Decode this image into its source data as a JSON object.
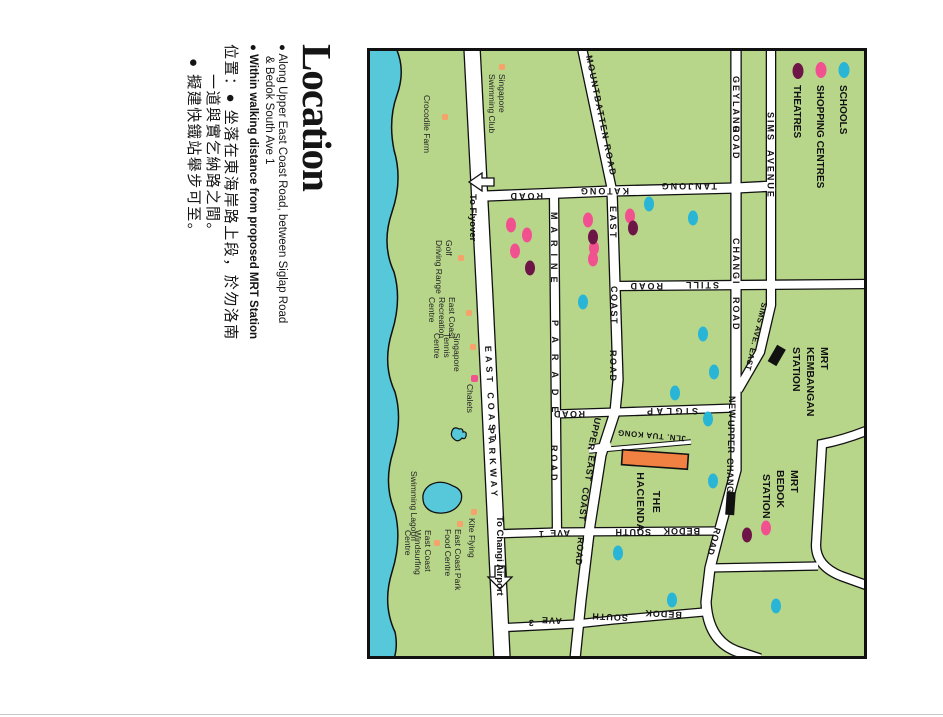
{
  "content": {
    "title": "Location",
    "bullet1_line1": "● Along Upper East Coast Road, between Siglap Road",
    "bullet1_line2": "& Bedok South Ave 1",
    "bullet2": "● Within walking distance from proposed MRT Station",
    "zh_line1": "位置：● 坐落在東海岸路上段，於勿洛南",
    "zh_line2": "一道與實乞納路之間。",
    "zh_line3": "● 擬建快鐵站舉步可至。"
  },
  "legend": {
    "schools": "SCHOOLS",
    "shopping": "SHOPPING CENTRES",
    "theatres": "THEATRES"
  },
  "roads": {
    "mountbatten": "MOUNTBATTEN ROAD",
    "geylang": "GEYLANG",
    "geylang_road": "ROAD",
    "sims": "SIMS",
    "sims_avenue": "AVENUE",
    "sims_ave_east": "SIMS AVE. EAST",
    "changi": "CHANGI",
    "changi_road": "ROAD",
    "tanjong": "TANJONG",
    "katong": "KATONG",
    "tanjong_road": "ROAD",
    "still": "STILL",
    "still_road": "ROAD",
    "east": "EAST",
    "coast": "COAST",
    "east_coast_road": "ROAD",
    "marine": "MARINE",
    "parade": "PARADE",
    "marine_road": "ROAD",
    "upper": "UPPER",
    "upper_east": "EAST",
    "upper_coast": "COAST",
    "upper_road": "ROAD",
    "new_word": "NEW",
    "new_upper": "UPPER",
    "new_changi": "CHANGI",
    "new_road": "ROAD",
    "siglap": "SIGLAP",
    "siglap_road": "ROAD",
    "bsa1_bedok": "BEDOK",
    "bsa1_south": "SOUTH",
    "bsa1_ave": "AVE",
    "bsa1_num": "1",
    "bsa3_bedok": "BEDOK",
    "bsa3_south": "SOUTH",
    "bsa3_ave": "AVE",
    "bsa3_num": "3",
    "ecp_east_coast": "EAST COAST",
    "ecp_parkway": "PARKWAY",
    "jln_tua_kong": "JLN. TUA KONG"
  },
  "stations": {
    "kembangan": [
      "MRT",
      "KEMBANGAN",
      "STATION"
    ],
    "bedok": [
      "MRT",
      "BEDOK",
      "STATION"
    ]
  },
  "places": {
    "swim1": "Singapore",
    "swim2": "Swimming Club",
    "crocodile": "Crocodile Farm",
    "golf1": "Golf",
    "golf2": "Driving Range",
    "rec1": "East Coast",
    "rec2": "Recreation",
    "rec3": "Centre",
    "tennis1": "Singapore",
    "tennis2": "Tennis",
    "tennis3": "Centre",
    "chalets": "Chalets",
    "lagoon": "Swimming Lagoon",
    "kite": "Kite Flying",
    "food1": "East Coast Park",
    "food2": "Food Centre",
    "wind1": "East Coast",
    "wind2": "Windsurfing",
    "wind3": "Centre",
    "hacienda1": "THE",
    "hacienda2": "HACIENDA"
  },
  "directions": {
    "flyover": "To Flyover",
    "airport": "To Changi Airport"
  },
  "colors": {
    "land": "#b7d68a",
    "sea": "#57c7da",
    "school": "#28b5d6",
    "shopping": "#f2518f",
    "theatre": "#6e1548",
    "site": "#f08142",
    "amenity": "#f5a36b"
  }
}
